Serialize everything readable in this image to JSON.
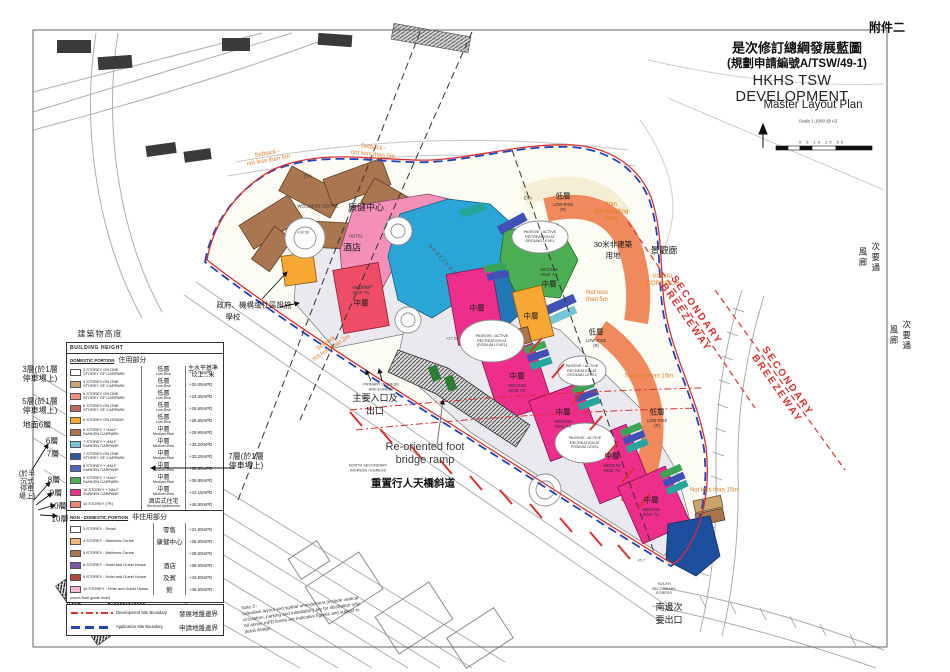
{
  "annex": "附件二",
  "title_block": {
    "line1_zh": "是次修訂總綱發展藍圖",
    "line2_zh": "(規劃申請編號A/TSW/49-1)",
    "title_en": "HKHS TSW DEVELOPMENT",
    "subtitle_en": "Master Layout Plan",
    "scale_note": "Scale 1:1000 @ A3",
    "scale_ticks": "0  5  10   20         50"
  },
  "colors": {
    "development_boundary": "#d93030",
    "application_boundary": "#2244bb",
    "annotation_orange": "#e07f28",
    "breezeway_red": "#d93030",
    "medium_rise_magenta": "#ed2e8b",
    "low_rise_orange": "#f0895c",
    "podium_grey": "#e9e9ef"
  },
  "legend": {
    "heading_zh": "建築物高度",
    "header": "BUILDING HEIGHT",
    "col_mpd_zh": "主水平基準\n以上...米",
    "domestic": {
      "section_en": "DOMESTIC PORTION",
      "section_zh": "住用部分",
      "rows": [
        {
          "color": "#ffffff",
          "label": "3 STOREY ON ONE\nSTOREY OF CARPARK",
          "rise_zh": "低層",
          "rise_en": "Low-Rise",
          "mpd": "+17.75mPD"
        },
        {
          "color": "#c9a56b",
          "label": "3 STOREY ON ONE\nSTOREY OF CARPARK",
          "rise_zh": "低層",
          "rise_en": "Low-Rise",
          "mpd": "+20.05mPD"
        },
        {
          "color": "#f2917d",
          "label": "5 STOREY ON ONE\nSTOREY OF CARPARK",
          "rise_zh": "低層",
          "rise_en": "Low-Rise",
          "mpd": "+24.35mPD"
        },
        {
          "color": "#c2655a",
          "label": "5 STOREY ON ONE\nSTOREY OF CARPARK",
          "rise_zh": "低層",
          "rise_en": "Low-Rise",
          "mpd": "+26.65mPD"
        },
        {
          "color": "#f7a733",
          "label": "6 STOREY ON GRADE",
          "rise_zh": "低層",
          "rise_en": "Low-Rise",
          "mpd": "+26.65mPD"
        },
        {
          "color": "#b5714e",
          "label": "6 STOREY + HALF\nSUNKEN CARPARK",
          "rise_zh": "中層",
          "rise_en": "Medium-Rise",
          "mpd": "+29.95mPD"
        },
        {
          "color": "#74c6d6",
          "label": "7 STOREY + HALF\nSUNKEN CARPARK",
          "rise_zh": "中層",
          "rise_en": "Medium-Rise",
          "mpd": "+33.20mPD"
        },
        {
          "color": "#2e57a6",
          "label": "7 STOREY ON ONE\nSTOREY OF CARPARK",
          "rise_zh": "中層",
          "rise_en": "Medium-Rise",
          "mpd": "+33.25mPD"
        },
        {
          "color": "#4a68bb",
          "label": "8 STOREY + HALF\nSUNKEN CARPARK",
          "rise_zh": "中層",
          "rise_en": "Medium-Rise",
          "mpd": "+36.55mPD"
        },
        {
          "color": "#4fae55",
          "label": "9 STOREY + HALF\nSUNKEN CARPARK",
          "rise_zh": "中層",
          "rise_en": "Medium-Rise",
          "mpd": "+39.85mPD"
        },
        {
          "color": "#f0318d",
          "label": "10 STOREY + HALF\nSUNKEN CARPARK",
          "rise_zh": "中層",
          "rise_en": "Medium-Rise",
          "mpd": "+43.15mPD"
        },
        {
          "color": "#f08477",
          "label": "10 STOREY (7R)",
          "rise_zh": "酒店式住宅",
          "rise_en": "Serviced Apartments",
          "mpd": "+46.50mPD"
        }
      ]
    },
    "non_domestic": {
      "section_en": "NON - DOMESTIC PORTION",
      "section_zh": "非住用部分",
      "rows": [
        {
          "color": "#ffffff",
          "label": "3 STOREY - Retail",
          "zh": "零售",
          "mpd": "+21.50mPD"
        },
        {
          "color": "#f3b978",
          "label": "4 STOREY - Wellness Centre",
          "zh": "康健中心",
          "mpd": "+25.50mPD"
        },
        {
          "color": "#a9754d",
          "label": "5 STOREY - Wellness Centre",
          "zh": "",
          "mpd": "+28.50mPD"
        },
        {
          "color": "#7b57a8",
          "label": "8 STOREY - Hotel and Guest House",
          "zh": "酒店",
          "mpd": "+39.50mPD"
        },
        {
          "color": "#b44a38",
          "label": "9 STOREY - Hotel and Guest House",
          "zh": "及賓",
          "mpd": "+43.50mPD"
        },
        {
          "color": "#f5b9d4",
          "label": "10 STOREY - Hotel and Guest House",
          "zh": "館",
          "mpd": "+46.50mPD"
        }
      ],
      "footnote": "(count from grade level)"
    },
    "boundaries": [
      {
        "style": "dev",
        "label_en": "Development Site Boundary",
        "label_zh": "發展地盤邊界"
      },
      {
        "style": "app",
        "label_en": "Application Site Boundary",
        "label_zh": "申請地盤邊界"
      }
    ]
  },
  "map_labels": [
    {
      "name": "legend-heading-zh",
      "text": "建築物高度",
      "x": 100,
      "y": 334,
      "rot": 0,
      "cls": "L-zh-xs"
    },
    {
      "name": "margin-note-3-storey",
      "text": "3層(於1層\n停車場上)",
      "x": 40,
      "y": 374,
      "rot": 0,
      "cls": "L-margin"
    },
    {
      "name": "margin-note-5-storey",
      "text": "5層(於1層\n停車場上)",
      "x": 40,
      "y": 406,
      "rot": 0,
      "cls": "L-margin"
    },
    {
      "name": "margin-note-ground-6",
      "text": "地面6層",
      "x": 37,
      "y": 425,
      "rot": 0,
      "cls": "L-margin"
    },
    {
      "name": "margin-note-6",
      "text": "6層",
      "x": 52,
      "y": 441,
      "rot": 0,
      "cls": "L-margin"
    },
    {
      "name": "margin-note-7",
      "text": "7層",
      "x": 53,
      "y": 454,
      "rot": 0,
      "cls": "L-margin"
    },
    {
      "name": "margin-note-half-sunken",
      "text": "(於半\n沉式\n停車\n場上)",
      "x": 27,
      "y": 486,
      "rot": 0,
      "cls": "L-margin-sm"
    },
    {
      "name": "margin-note-8",
      "text": "8層",
      "x": 54,
      "y": 480,
      "rot": 0,
      "cls": "L-margin"
    },
    {
      "name": "margin-note-9",
      "text": "9層",
      "x": 56,
      "y": 493,
      "rot": 0,
      "cls": "L-margin"
    },
    {
      "name": "margin-note-10a",
      "text": "10層",
      "x": 58,
      "y": 506,
      "rot": 0,
      "cls": "L-margin"
    },
    {
      "name": "margin-note-10b",
      "text": "10層",
      "x": 60,
      "y": 519,
      "rot": 0,
      "cls": "L-margin"
    },
    {
      "name": "margin-note-7-carpark",
      "text": "7層(於1層\n停車場上)",
      "x": 246,
      "y": 461,
      "rot": 0,
      "cls": "L-margin"
    },
    {
      "name": "label-wellness-centre-en",
      "text": "WELLNESS CENTRE",
      "x": 318,
      "y": 206,
      "rot": 0,
      "cls": "L-en-tiny"
    },
    {
      "name": "label-wellness-centre-zh",
      "text": "康健中心",
      "x": 366,
      "y": 207,
      "rot": 0,
      "cls": "L-zh"
    },
    {
      "name": "label-hotel-en",
      "text": "HOTEL",
      "x": 356,
      "y": 236,
      "rot": 0,
      "cls": "L-en-tiny"
    },
    {
      "name": "label-hotel-zh",
      "text": "酒店",
      "x": 352,
      "y": 247,
      "rot": 0,
      "cls": "L-zh"
    },
    {
      "name": "label-medium-rise-7s-en",
      "text": "MEDIUM\nRISE 7S",
      "x": 361,
      "y": 290,
      "rot": 0,
      "cls": "L-en-tiny"
    },
    {
      "name": "label-medium-rise-7s-zh",
      "text": "中層",
      "x": 361,
      "y": 303,
      "rot": 0,
      "cls": "L-zh-sm"
    },
    {
      "name": "label-breezeway-axis",
      "text": "BREEZEWAY",
      "x": 444,
      "y": 262,
      "rot": 48,
      "cls": "L-diag"
    },
    {
      "name": "label-medium-rise-green-en",
      "text": "MEDIUM\nRISE 7S",
      "x": 549,
      "y": 272,
      "rot": 0,
      "cls": "L-en-tiny"
    },
    {
      "name": "label-medium-rise-green-zh",
      "text": "中層",
      "x": 549,
      "y": 284,
      "rot": 0,
      "cls": "L-zh-sm"
    },
    {
      "name": "label-low-rise-cream-zh",
      "text": "低層",
      "x": 563,
      "y": 196,
      "rot": 0,
      "cls": "L-zh-sm"
    },
    {
      "name": "label-low-rise-cream-en",
      "text": "LOW-RISE\n(R)",
      "x": 563,
      "y": 207,
      "rot": 0,
      "cls": "L-en-tiny"
    },
    {
      "name": "label-low-rise-orange-top-zh",
      "text": "低層",
      "x": 596,
      "y": 332,
      "rot": 0,
      "cls": "L-zh-sm"
    },
    {
      "name": "label-low-rise-orange-top-en",
      "text": "LOW RISE\n(R)",
      "x": 596,
      "y": 343,
      "rot": 0,
      "cls": "L-en-tiny"
    },
    {
      "name": "label-low-rise-orange-low-zh",
      "text": "低層",
      "x": 657,
      "y": 412,
      "rot": 0,
      "cls": "L-zh-sm"
    },
    {
      "name": "label-low-rise-orange-low-en",
      "text": "LOW RISE\n(R)",
      "x": 657,
      "y": 423,
      "rot": 0,
      "cls": "L-en-tiny"
    },
    {
      "name": "label-medium-rise-m1-zh",
      "text": "中層",
      "x": 517,
      "y": 376,
      "rot": 0,
      "cls": "L-zh-sm"
    },
    {
      "name": "label-medium-rise-m1-en",
      "text": "MEDIUM\nRISE 7S",
      "x": 517,
      "y": 388,
      "rot": 0,
      "cls": "L-en-tiny"
    },
    {
      "name": "label-medium-rise-m2-zh",
      "text": "中層",
      "x": 563,
      "y": 412,
      "rot": 0,
      "cls": "L-zh-sm"
    },
    {
      "name": "label-medium-rise-m2-en",
      "text": "MEDIUM\nRISE 7S",
      "x": 563,
      "y": 424,
      "rot": 0,
      "cls": "L-en-tiny"
    },
    {
      "name": "label-medium-rise-m3-zh",
      "text": "中層",
      "x": 612,
      "y": 456,
      "rot": 0,
      "cls": "L-zh-sm"
    },
    {
      "name": "label-medium-rise-m3-en",
      "text": "MEDIUM\nRISE 7S",
      "x": 612,
      "y": 468,
      "rot": 0,
      "cls": "L-en-tiny"
    },
    {
      "name": "label-medium-rise-m4-zh",
      "text": "中層",
      "x": 651,
      "y": 500,
      "rot": 0,
      "cls": "L-zh-sm"
    },
    {
      "name": "label-medium-rise-m4-en",
      "text": "MEDIUM\nRISE 7S",
      "x": 651,
      "y": 512,
      "rot": 0,
      "cls": "L-en-tiny"
    },
    {
      "name": "label-medium-rise-center-zh",
      "text": "中層",
      "x": 477,
      "y": 308,
      "rot": 0,
      "cls": "L-zh-sm"
    },
    {
      "name": "label-medium-rise-orange-zh",
      "text": "中層",
      "x": 531,
      "y": 316,
      "rot": 0,
      "cls": "L-zh-sm"
    },
    {
      "name": "label-recreation-podium-a",
      "text": "PASSIVE / ACTIVE\nRECREATION AT\n(PODIUM LEVEL)",
      "x": 492,
      "y": 341,
      "rot": 0,
      "cls": "L-en-micro"
    },
    {
      "name": "label-recreation-podium-b",
      "text": "PASSIVE / ACTIVE\nRECREATION AT\nPODIUM LEVEL",
      "x": 585,
      "y": 443,
      "rot": 0,
      "cls": "L-en-micro"
    },
    {
      "name": "label-recreation-ground-a",
      "text": "PASSIVE / ACTIVE\nRECREATION AT\nGROUND LEVEL",
      "x": 540,
      "y": 237,
      "rot": 0,
      "cls": "L-en-micro"
    },
    {
      "name": "label-recreation-ground-b",
      "text": "PASSIVE / ACTIVE\nRECREATION AT\nGROUND LEVEL",
      "x": 582,
      "y": 371,
      "rot": 0,
      "cls": "L-en-micro"
    },
    {
      "name": "label-scenic-corridor-zh",
      "text": "景觀廊",
      "x": 664,
      "y": 250,
      "rot": 0,
      "cls": "L-zh"
    },
    {
      "name": "label-visual-corridor-en",
      "text": "VISUAL\nCORRIDOR",
      "x": 663,
      "y": 281,
      "rot": 0,
      "cls": "L-orange"
    },
    {
      "name": "label-non-building-area-en",
      "text": "30m\nNon-Building\nArea",
      "x": 611,
      "y": 213,
      "rot": 0,
      "cls": "L-orange"
    },
    {
      "name": "label-non-building-area-zh",
      "text": "30米非建築\n用地",
      "x": 613,
      "y": 250,
      "rot": 0,
      "cls": "L-zh-sm"
    },
    {
      "name": "label-not-less-5m",
      "text": "Not less\nthan 5m",
      "x": 597,
      "y": 297,
      "rot": 0,
      "cls": "L-orange"
    },
    {
      "name": "label-not-less-15m-a",
      "text": "Not less than 15m",
      "x": 649,
      "y": 377,
      "rot": 0,
      "cls": "L-orange"
    },
    {
      "name": "label-not-less-15m-b",
      "text": "Not less than 15m",
      "x": 714,
      "y": 491,
      "rot": 0,
      "cls": "L-orange"
    },
    {
      "name": "label-secondary-breezeway-a",
      "text": "SECONDARY\nBREEZEWAY",
      "x": 691,
      "y": 314,
      "rot": 55,
      "cls": "L-breeze"
    },
    {
      "name": "label-secondary-breezeway-b",
      "text": "SECONDARY\nBREEZEWAY",
      "x": 782,
      "y": 385,
      "rot": 55,
      "cls": "L-breeze"
    },
    {
      "name": "label-secondary-breezeway-zh-a",
      "text": "次要通\n風廊",
      "x": 869,
      "y": 258,
      "rot": 0,
      "cls": "L-vert"
    },
    {
      "name": "label-secondary-breezeway-zh-b",
      "text": "次要通\n風廊",
      "x": 900,
      "y": 336,
      "rot": 0,
      "cls": "L-vert"
    },
    {
      "name": "label-setback-5m-a",
      "text": "Setback -\nnot less than 5m",
      "x": 268,
      "y": 158,
      "rot": -10,
      "cls": "L-orange"
    },
    {
      "name": "label-setback-5m-b",
      "text": "Setback -\nnot less than 5m",
      "x": 373,
      "y": 152,
      "rot": 6,
      "cls": "L-orange"
    },
    {
      "name": "label-setback-2m",
      "text": "Setback -\nnot less than 2m",
      "x": 330,
      "y": 346,
      "rot": -33,
      "cls": "L-orange"
    },
    {
      "name": "label-eva-a",
      "text": "EVA",
      "x": 308,
      "y": 176,
      "rot": 0,
      "cls": "L-en-tiny"
    },
    {
      "name": "label-eva-b",
      "text": "EVA",
      "x": 528,
      "y": 198,
      "rot": 0,
      "cls": "L-en-tiny"
    },
    {
      "name": "label-primary-ingress-en",
      "text": "PRIMARY INGRESS\nAND EGRESS",
      "x": 381,
      "y": 387,
      "rot": 0,
      "cls": "L-en-micro"
    },
    {
      "name": "label-primary-ingress-zh",
      "text": "主要入口及\n出口",
      "x": 375,
      "y": 404,
      "rot": 0,
      "cls": "L-zh"
    },
    {
      "name": "label-north-ingress-en",
      "text": "NORTH SECONDARY\nINGRESS / EGRESS",
      "x": 368,
      "y": 468,
      "rot": 0,
      "cls": "L-en-micro"
    },
    {
      "name": "label-footbridge-en",
      "text": "Re-oriented foot\nbridge ramp",
      "x": 425,
      "y": 454,
      "rot": 0,
      "cls": "L-big"
    },
    {
      "name": "label-footbridge-zh",
      "text": "重置行人天橋斜道",
      "x": 413,
      "y": 483,
      "rot": 0,
      "cls": "L-zh-bold"
    },
    {
      "name": "label-south-egress-en",
      "text": "SOUTH\nSECONDARY\nEGRESS",
      "x": 664,
      "y": 589,
      "rot": 0,
      "cls": "L-en-micro"
    },
    {
      "name": "label-south-egress-zh",
      "text": "南邊次\n要出口",
      "x": 669,
      "y": 613,
      "rot": 0,
      "cls": "L-zh"
    },
    {
      "name": "label-gic-zh",
      "text": "政府、機構或社區設施",
      "x": 254,
      "y": 305,
      "rot": 0,
      "cls": "L-zh-sm"
    },
    {
      "name": "label-school-zh",
      "text": "學校",
      "x": 233,
      "y": 317,
      "rot": 0,
      "cls": "L-zh-sm"
    },
    {
      "name": "label-elev-1",
      "text": "+18.50",
      "x": 303,
      "y": 232,
      "rot": 0,
      "cls": "L-elev"
    },
    {
      "name": "label-elev-2",
      "text": "+11.50",
      "x": 367,
      "y": 286,
      "rot": 0,
      "cls": "L-elev"
    },
    {
      "name": "label-elev-3",
      "text": "+17.50",
      "x": 452,
      "y": 338,
      "rot": 0,
      "cls": "L-elev"
    },
    {
      "name": "label-elev-4",
      "text": "+5.7",
      "x": 641,
      "y": 560,
      "rot": 0,
      "cls": "L-elev"
    },
    {
      "name": "plan-note",
      "text": "Note 3 :\nIndicative layout and spatial arrangement (include vertical\ncirculation, parking and installation) are for illustration only.\nAll above mPD levels are indicative figures and subject to\ndetail design.",
      "x": 302,
      "y": 612,
      "rot": -8,
      "cls": "L-note"
    }
  ]
}
